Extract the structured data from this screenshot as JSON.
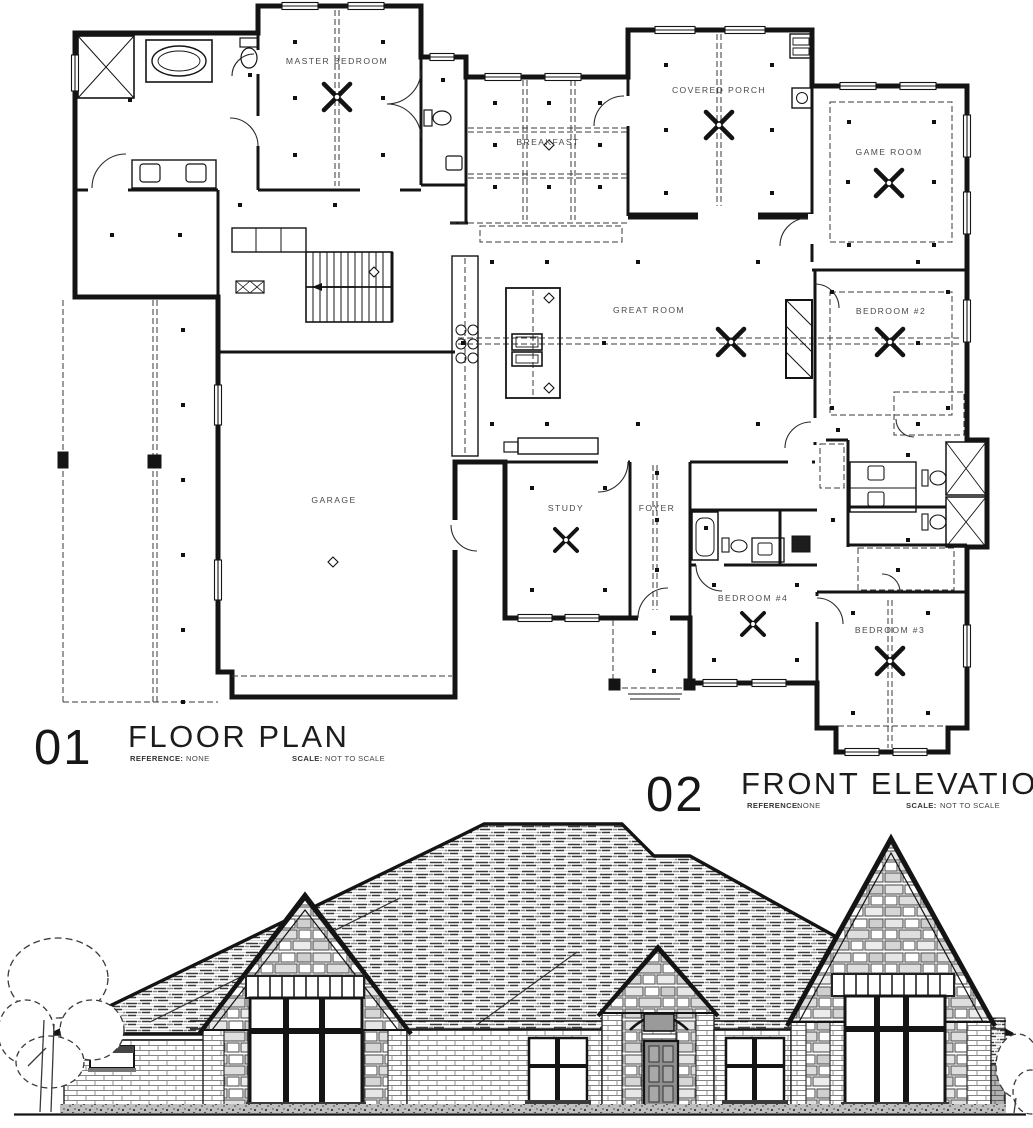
{
  "sheet": {
    "background": "#ffffff",
    "ink": "#141414",
    "label_color": "#4a4a4a",
    "door_color": "#8f8f8f"
  },
  "titles": {
    "floor_plan": {
      "number": "01",
      "name": "FLOOR PLAN",
      "reference_label": "REFERENCE:",
      "reference_value": "NONE",
      "scale_label": "SCALE:",
      "scale_value": "NOT TO SCALE"
    },
    "front_elevation": {
      "number": "02",
      "name": "FRONT ELEVATION",
      "reference_label": "REFERENCE:",
      "reference_value": "NONE",
      "scale_label": "SCALE:",
      "scale_value": "NOT TO SCALE"
    }
  },
  "floor_plan": {
    "rooms": [
      {
        "name": "MASTER BEDROOM"
      },
      {
        "name": "BREAKFAST"
      },
      {
        "name": "COVERED PORCH"
      },
      {
        "name": "GAME ROOM"
      },
      {
        "name": "BEDROOM #2"
      },
      {
        "name": "GREAT ROOM"
      },
      {
        "name": "GARAGE"
      },
      {
        "name": "STUDY"
      },
      {
        "name": "FOYER"
      },
      {
        "name": "BEDROOM #4"
      },
      {
        "name": "BEDROOM #3"
      }
    ]
  }
}
